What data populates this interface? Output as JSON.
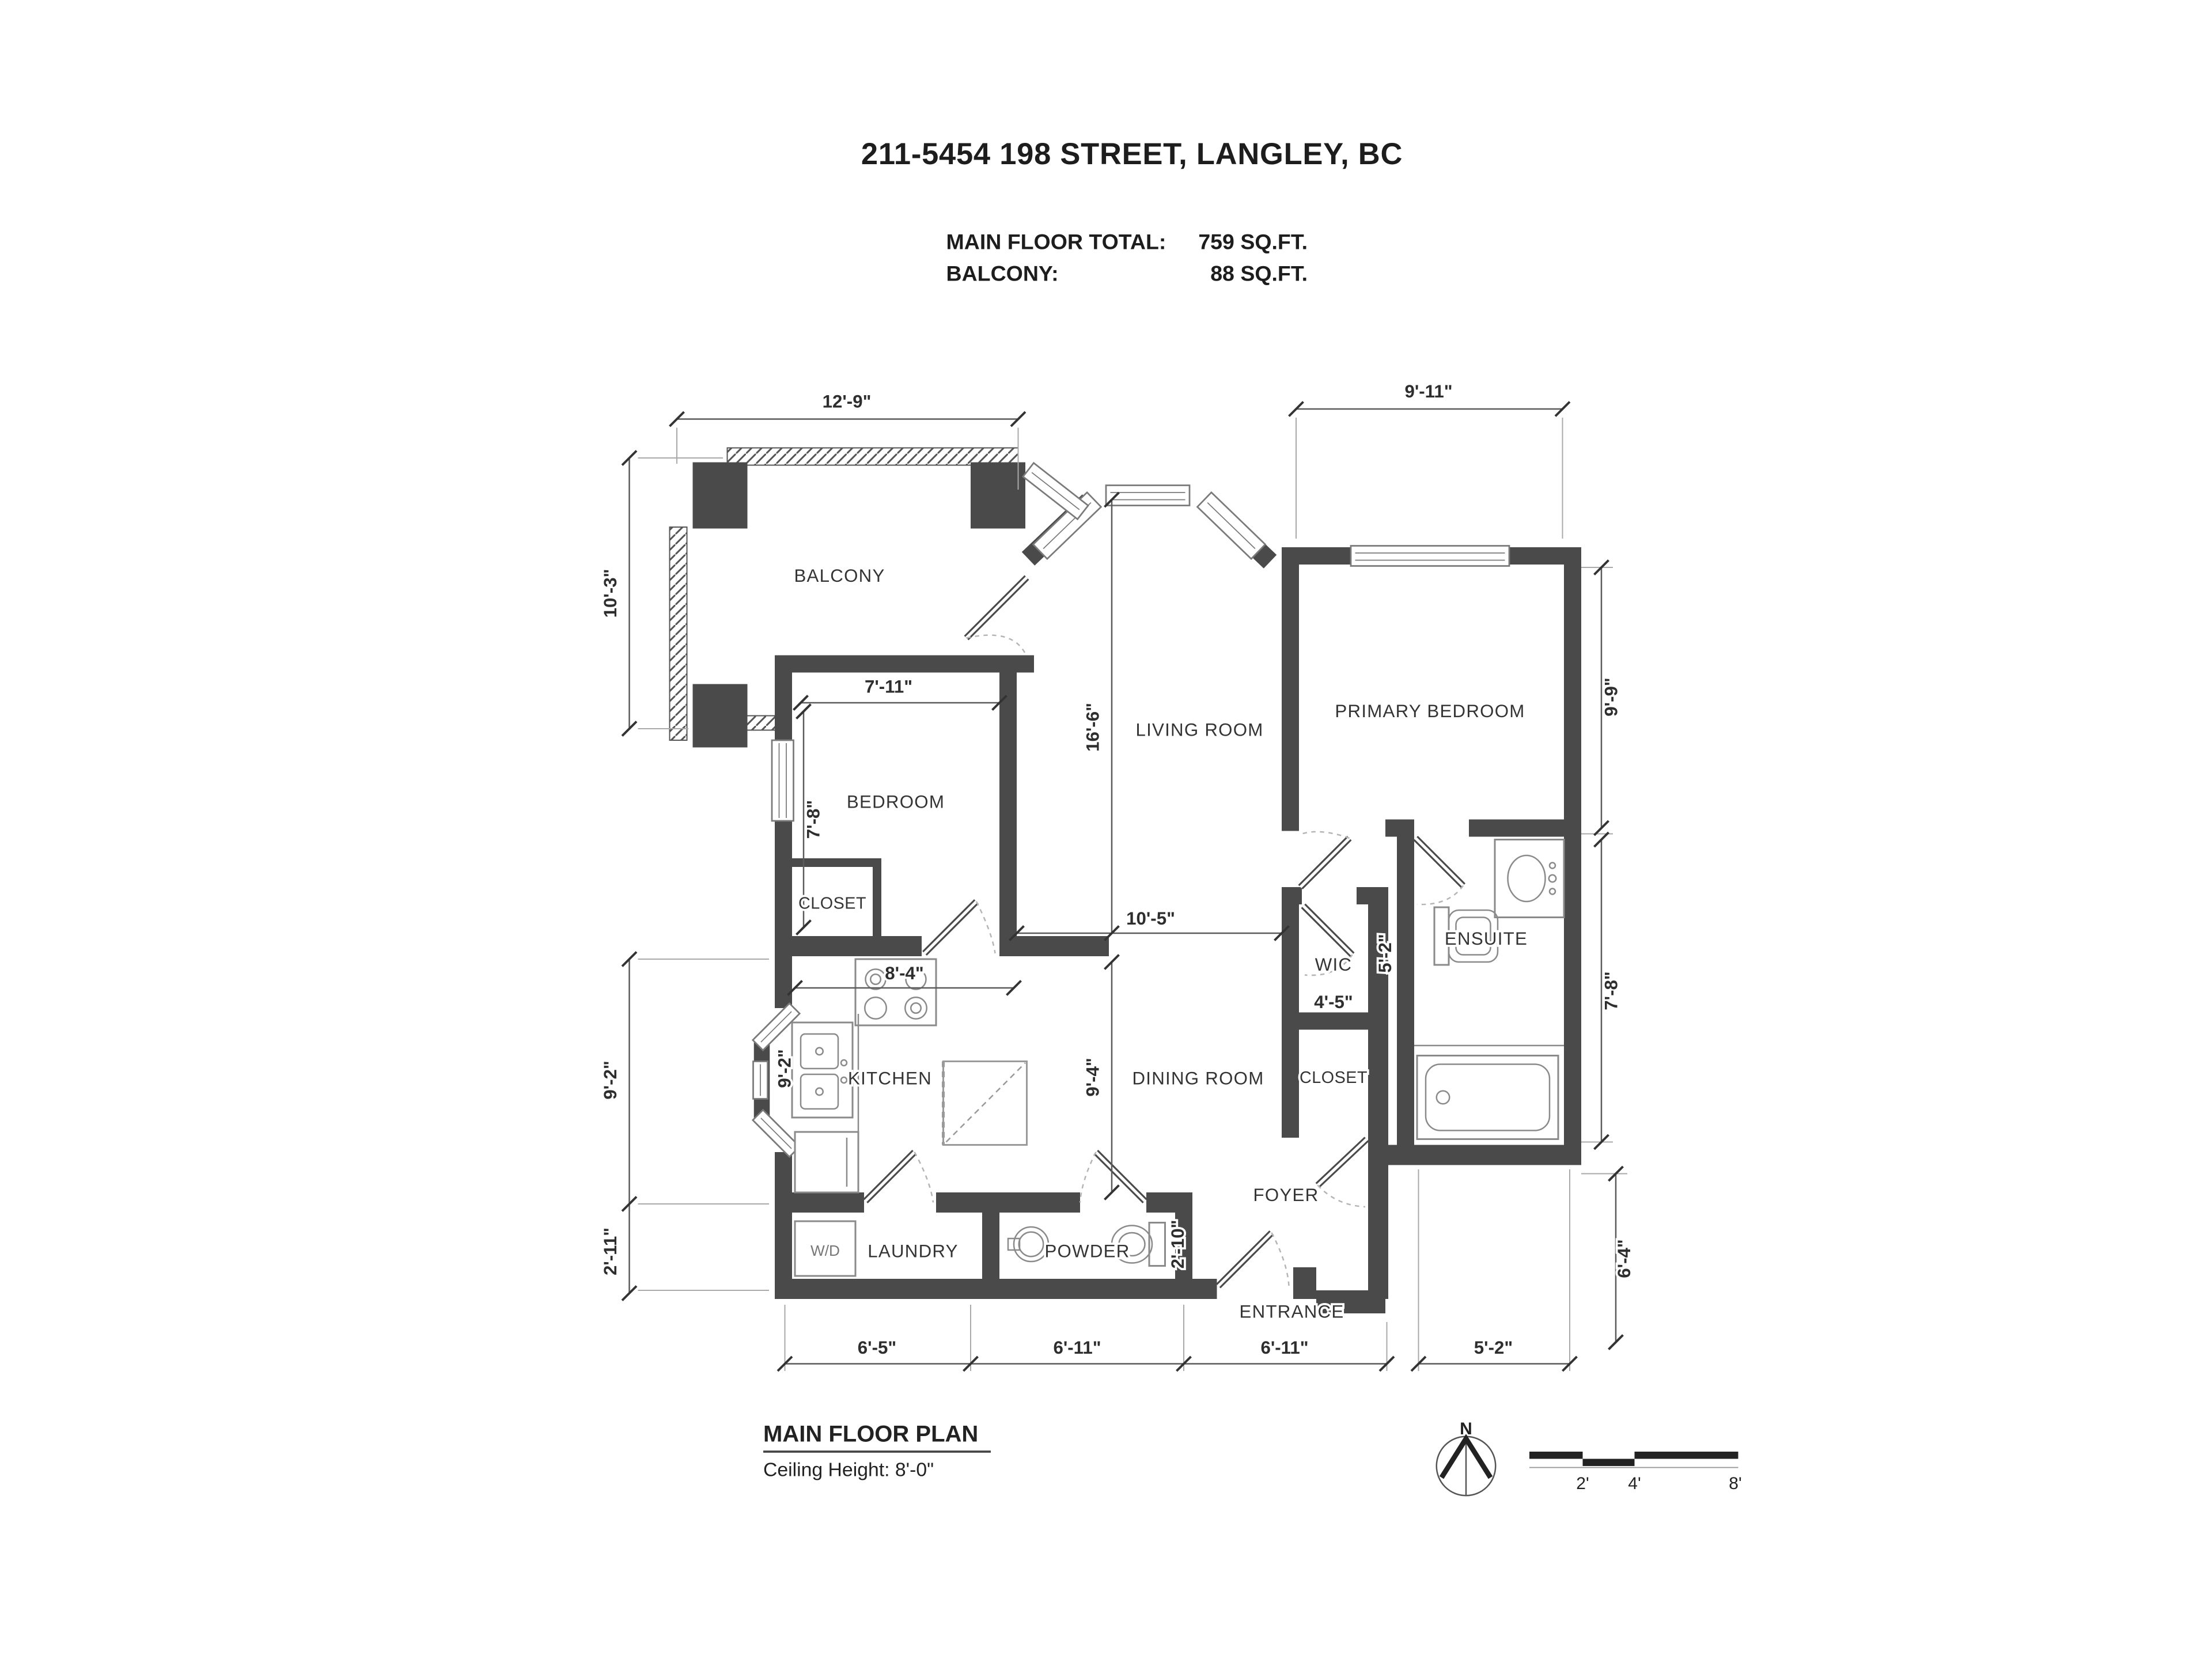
{
  "header": {
    "title": "211-5454 198 STREET, LANGLEY, BC",
    "rows": [
      {
        "label": "MAIN FLOOR TOTAL:",
        "value": "759 SQ.FT."
      },
      {
        "label": "BALCONY:",
        "value": "88 SQ.FT."
      }
    ]
  },
  "rooms": {
    "balcony": "BALCONY",
    "bedroom": "BEDROOM",
    "bedroom_closet": "CLOSET",
    "living_room": "LIVING ROOM",
    "primary_bedroom": "PRIMARY BEDROOM",
    "wic": "WIC",
    "ensuite": "ENSUITE",
    "kitchen": "KITCHEN",
    "dining_room": "DINING ROOM",
    "foyer_closet": "CLOSET",
    "foyer": "FOYER",
    "laundry": "LAUNDRY",
    "washer_dryer": "W/D",
    "powder": "POWDER",
    "entrance": "ENTRANCE"
  },
  "dims": {
    "balcony_width": "12'-9\"",
    "primary_width": "9'-11\"",
    "balcony_depth": "10'-3\"",
    "living_length": "16'-6\"",
    "bedroom_width": "7'-11\"",
    "bedroom_depth": "7'-8\"",
    "primary_depth": "9'-9\"",
    "ensuite_depth": "7'-8\"",
    "hall_width": "10'-5\"",
    "kitchen_width": "8'-4\"",
    "kitchen_depth": "9'-2\"",
    "kitchen_inner_depth": "9'-2\"",
    "laundry_depth": "2'-11\"",
    "dining_depth": "9'-4\"",
    "wic_depth": "5'-2\"",
    "wic_width": "4'-5\"",
    "powder_depth": "2'-10\"",
    "entry_side_depth": "6'-4\"",
    "bottom_laundry": "6'-5\"",
    "bottom_powder": "6'-11\"",
    "bottom_foyer": "6'-11\"",
    "bottom_right": "5'-2\""
  },
  "footer": {
    "plan_title": "MAIN FLOOR PLAN",
    "ceiling": "Ceiling Height: 8'-0\"",
    "north": "N",
    "scale_labels": [
      "2'",
      "4'",
      "8'"
    ]
  }
}
